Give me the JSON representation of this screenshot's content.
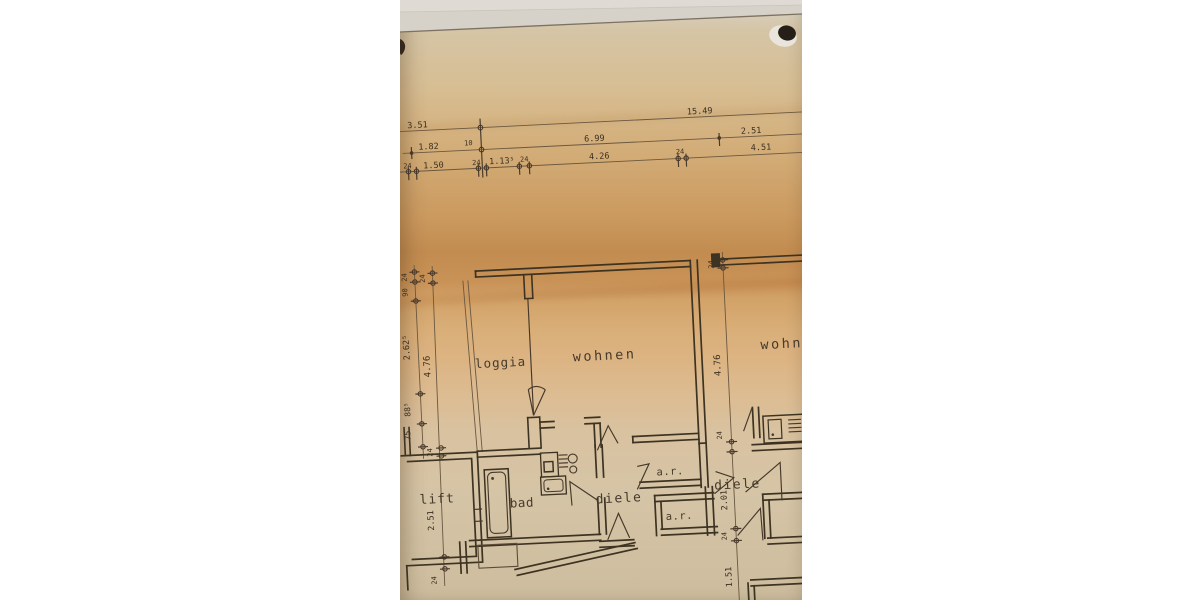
{
  "photo": {
    "colors": {
      "paper_warm": "#c28c50",
      "paper_light": "#d5c4a6",
      "table_surface": "#d6d1c9",
      "ink": "#3d3322",
      "hole_dark": "#251f17"
    }
  },
  "plan": {
    "rooms": {
      "loggia": "loggia",
      "wohnen": "wohnen",
      "wohn_right": "wohnen",
      "lift": "lift",
      "bad": "bad",
      "diele": "diele",
      "ar1": "a.r.",
      "ar2": "a.r.",
      "diele_right": "diele"
    },
    "dims_top_row1": {
      "a": "3.51",
      "b": "15.49"
    },
    "dims_top_row2": {
      "a": "1.82",
      "b": "10",
      "c": "6.99",
      "d": "2.51"
    },
    "dims_top_row3": {
      "a": "24",
      "b": "1.50",
      "c": "24",
      "d": "1.13⁵",
      "e": "24",
      "f": "4.26",
      "g": "24",
      "h": "4.51"
    },
    "dims_left_outer": {
      "a": "24",
      "b": "90",
      "c": "2.62⁵",
      "d": "88⁵",
      "e": "75"
    },
    "dims_left_inner": {
      "a": "24",
      "b": "4.76",
      "c": "24",
      "d": "2.51",
      "e": "24"
    },
    "dims_right": {
      "a": "24",
      "b": "4.76",
      "c": "24",
      "d": "2.01",
      "e": "24",
      "f": "1.51"
    }
  }
}
